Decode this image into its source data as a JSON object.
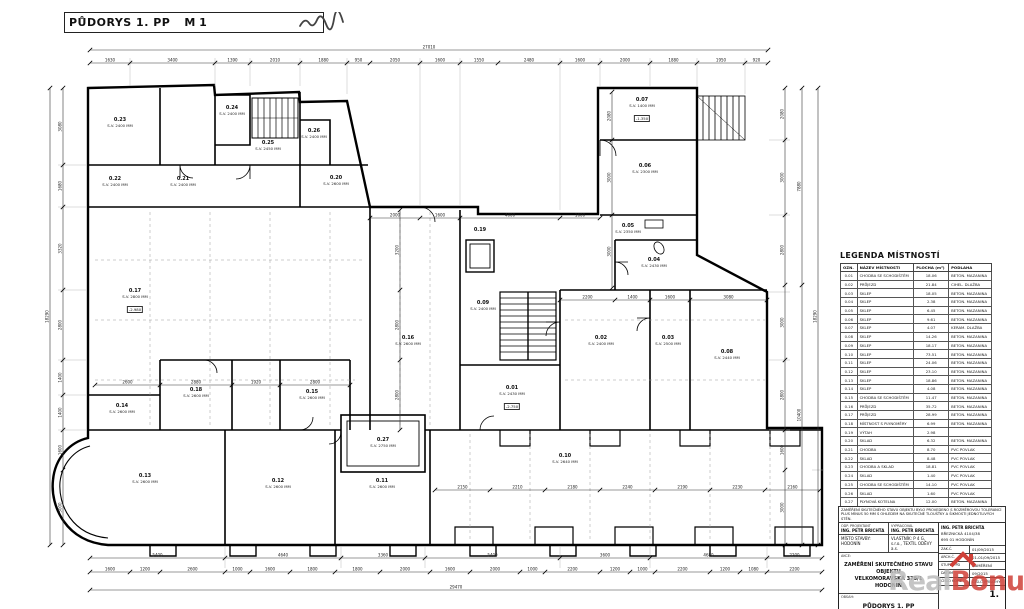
{
  "title": {
    "text": "PŮDORYS 1. PP",
    "scale": "M 1"
  },
  "plan": {
    "rooms": [
      {
        "id": "0.23",
        "sv": "S.V. 2400 MM",
        "x": 120,
        "y": 122
      },
      {
        "id": "0.24",
        "sv": "S.V. 2400 MM",
        "x": 232,
        "y": 110
      },
      {
        "id": "0.25",
        "sv": "S.V. 2450 MM",
        "x": 268,
        "y": 145
      },
      {
        "id": "0.26",
        "sv": "S.V. 2400 MM",
        "x": 314,
        "y": 133
      },
      {
        "id": "0.20",
        "sv": "S.V. 2600 MM",
        "x": 336,
        "y": 180
      },
      {
        "id": "0.22",
        "sv": "S.V. 2400 MM",
        "x": 115,
        "y": 181
      },
      {
        "id": "0.21",
        "sv": "S.V. 2400 MM",
        "x": 183,
        "y": 181
      },
      {
        "id": "0.17",
        "sv": "S.V. 2800 MM",
        "x": 135,
        "y": 293
      },
      {
        "id": "0.16",
        "sv": "S.V. 2600 MM",
        "x": 408,
        "y": 340
      },
      {
        "id": "0.09",
        "sv": "S.V. 2400 MM",
        "x": 483,
        "y": 305
      },
      {
        "id": "0.19",
        "sv": "",
        "x": 480,
        "y": 232
      },
      {
        "id": "0.01",
        "sv": "S.V. 2430 MM",
        "x": 512,
        "y": 390
      },
      {
        "id": "0.02",
        "sv": "S.V. 2400 MM",
        "x": 601,
        "y": 340
      },
      {
        "id": "0.03",
        "sv": "S.V. 2500 MM",
        "x": 668,
        "y": 340
      },
      {
        "id": "0.04",
        "sv": "S.V. 2430 MM",
        "x": 654,
        "y": 262
      },
      {
        "id": "0.05",
        "sv": "S.V. 2350 MM",
        "x": 628,
        "y": 228
      },
      {
        "id": "0.06",
        "sv": "S.V. 2300 MM",
        "x": 645,
        "y": 168
      },
      {
        "id": "0.07",
        "sv": "S.V. 1400 MM",
        "x": 642,
        "y": 102
      },
      {
        "id": "0.08",
        "sv": "S.V. 2440 MM",
        "x": 727,
        "y": 354
      },
      {
        "id": "0.10",
        "sv": "S.V. 2640 MM",
        "x": 565,
        "y": 458
      },
      {
        "id": "0.11",
        "sv": "S.V. 2600 MM",
        "x": 382,
        "y": 483
      },
      {
        "id": "0.12",
        "sv": "S.V. 2600 MM",
        "x": 278,
        "y": 483
      },
      {
        "id": "0.13",
        "sv": "S.V. 2600 MM",
        "x": 145,
        "y": 478
      },
      {
        "id": "0.14",
        "sv": "S.V. 2600 MM",
        "x": 122,
        "y": 408
      },
      {
        "id": "0.15",
        "sv": "S.V. 2600 MM",
        "x": 312,
        "y": 394
      },
      {
        "id": "0.18",
        "sv": "S.V. 2600 MM",
        "x": 196,
        "y": 392
      },
      {
        "id": "0.27",
        "sv": "S.V. 2750 MM",
        "x": 383,
        "y": 442
      }
    ],
    "elev_tags": [
      {
        "text": "-2.980",
        "x": 135,
        "y": 306
      },
      {
        "text": "-1.350",
        "x": 642,
        "y": 115
      },
      {
        "text": "-2.750",
        "x": 512,
        "y": 403
      }
    ]
  },
  "dims": {
    "chains": [
      {
        "o": "h",
        "p": 50,
        "cuts": [
          90,
          768
        ],
        "labels": [
          "27010"
        ]
      },
      {
        "o": "h",
        "p": 63,
        "cuts": [
          90,
          130,
          215,
          250,
          300,
          347,
          370,
          420,
          460,
          498,
          560,
          600,
          650,
          697,
          745,
          768
        ],
        "labels": [
          "1630",
          "3400",
          "1390",
          "2010",
          "1880",
          "950",
          "2050",
          "1600",
          "1550",
          "2480",
          "1600",
          "2000",
          "1880",
          "1950",
          "920"
        ]
      },
      {
        "o": "v",
        "p": 50,
        "cuts": [
          88,
          545
        ],
        "labels": [
          "18290"
        ]
      },
      {
        "o": "v",
        "p": 63,
        "cuts": [
          88,
          165,
          207,
          290,
          360,
          395,
          430,
          470,
          545
        ],
        "labels": [
          "3080",
          "1680",
          "3320",
          "2800",
          "1400",
          "1400",
          "1600",
          "3000"
        ]
      },
      {
        "o": "h",
        "p": 558,
        "cuts": [
          90,
          225,
          341,
          425,
          560,
          650,
          767,
          822
        ],
        "labels": [
          "5400",
          "4640",
          "3360",
          "5400",
          "3600",
          "4680",
          "2200"
        ]
      },
      {
        "o": "h",
        "p": 572,
        "cuts": [
          90,
          130,
          160,
          225,
          250,
          290,
          335,
          380,
          430,
          470,
          520,
          545,
          600,
          630,
          655,
          710,
          740,
          767,
          822
        ],
        "labels": [
          "1600",
          "1200",
          "2600",
          "1000",
          "1600",
          "1800",
          "1800",
          "2000",
          "1600",
          "2000",
          "1000",
          "2200",
          "1200",
          "1000",
          "2200",
          "1200",
          "1080",
          "2200"
        ]
      },
      {
        "o": "h",
        "p": 590,
        "cuts": [
          90,
          822
        ],
        "labels": [
          "29470"
        ]
      },
      {
        "o": "v",
        "p": 785,
        "cuts": [
          88,
          140,
          215,
          285,
          360,
          430,
          470,
          545
        ],
        "labels": [
          "2080",
          "3000",
          "2800",
          "3000",
          "2800",
          "1600",
          "3000"
        ]
      },
      {
        "o": "v",
        "p": 802,
        "cuts": [
          88,
          285,
          545
        ],
        "labels": [
          "7880",
          "10400"
        ]
      },
      {
        "o": "v",
        "p": 818,
        "cuts": [
          88,
          545
        ],
        "labels": [
          "18290"
        ]
      },
      {
        "o": "h",
        "p": 218,
        "cuts": [
          370,
          420,
          460,
          560,
          600
        ],
        "labels": [
          "2000",
          "1600",
          "4000",
          "1600"
        ]
      },
      {
        "o": "h",
        "p": 385,
        "cuts": [
          95,
          160,
          232,
          280,
          350
        ],
        "labels": [
          "2600",
          "2880",
          "1920",
          "2800"
        ]
      },
      {
        "o": "h",
        "p": 490,
        "cuts": [
          435,
          490,
          545,
          600,
          655,
          710,
          765,
          820
        ],
        "labels": [
          "2150",
          "2210",
          "2180",
          "2240",
          "2190",
          "2230",
          "2160"
        ]
      },
      {
        "o": "v",
        "p": 400,
        "cuts": [
          210,
          290,
          360,
          430
        ],
        "labels": [
          "3200",
          "2800",
          "2800"
        ]
      },
      {
        "o": "h",
        "p": 300,
        "cuts": [
          560,
          615,
          650,
          690,
          767
        ],
        "labels": [
          "2200",
          "1400",
          "1600",
          "3080"
        ]
      },
      {
        "o": "v",
        "p": 612,
        "cuts": [
          92,
          140,
          215,
          288
        ],
        "labels": [
          "2080",
          "3000",
          "3000"
        ]
      }
    ]
  },
  "legend": {
    "title": "LEGENDA MÍSTNOSTÍ",
    "columns": [
      "OZN.",
      "NÁZEV MÍSTNOSTI",
      "PLOCHA (m²)",
      "PODLAHA"
    ],
    "rows": [
      [
        "0.01",
        "CHODBA SE SCHODIŠTĚM",
        "18.06",
        "BETON. MAZANINA"
      ],
      [
        "0.02",
        "PRŮJEZD",
        "21.84",
        "CIHEL. DLAŽBA"
      ],
      [
        "0.03",
        "SKLEP",
        "18.05",
        "BETON. MAZANINA"
      ],
      [
        "0.04",
        "SKLEP",
        "2.38",
        "BETON. MAZANINA"
      ],
      [
        "0.05",
        "SKLEP",
        "6.45",
        "BETON. MAZANINA"
      ],
      [
        "0.06",
        "SKLEP",
        "9.61",
        "BETON. MAZANINA"
      ],
      [
        "0.07",
        "SKLEP",
        "4.07",
        "KERAM. DLAŽBA"
      ],
      [
        "0.08",
        "SKLEP",
        "14.26",
        "BETON. MAZANINA"
      ],
      [
        "0.09",
        "SKLEP",
        "18.17",
        "BETON. MAZANINA"
      ],
      [
        "0.10",
        "SKLEP",
        "73.51",
        "BETON. MAZANINA"
      ],
      [
        "0.11",
        "SKLEP",
        "24.06",
        "BETON. MAZANINA"
      ],
      [
        "0.12",
        "SKLEP",
        "23.10",
        "BETON. MAZANINA"
      ],
      [
        "0.13",
        "SKLEP",
        "18.86",
        "BETON. MAZANINA"
      ],
      [
        "0.14",
        "SKLEP",
        "4.08",
        "BETON. MAZANINA"
      ],
      [
        "0.15",
        "CHODBA SE SCHODIŠTĚM",
        "11.47",
        "BETON. MAZANINA"
      ],
      [
        "0.16",
        "PRŮJEZD",
        "35.72",
        "BETON. MAZANINA"
      ],
      [
        "0.17",
        "PRŮJEZD",
        "28.99",
        "BETON. MAZANINA"
      ],
      [
        "0.18",
        "MÍSTNOST S PLYNOMĚRY",
        "6.99",
        "BETON. MAZANINA"
      ],
      [
        "0.19",
        "VÝTAH",
        "2.98",
        ""
      ],
      [
        "0.20",
        "SKLAD",
        "6.32",
        "BETON. MAZANINA"
      ],
      [
        "0.21",
        "CHODBA",
        "8.70",
        "PVC POVLAK"
      ],
      [
        "0.22",
        "SKLAD",
        "8.48",
        "PVC POVLAK"
      ],
      [
        "0.23",
        "CHODBA A SKLAD",
        "18.81",
        "PVC POVLAK"
      ],
      [
        "0.24",
        "SKLAD",
        "1.40",
        "PVC POVLAK"
      ],
      [
        "0.25",
        "CHODBA SE SCHODIŠTĚM",
        "14.10",
        "PVC POVLAK"
      ],
      [
        "0.26",
        "SKLAD",
        "1.60",
        "PVC POVLAK"
      ],
      [
        "0.27",
        "PLYNOVÁ KOTELNA",
        "12.00",
        "BETON. MAZANINA"
      ]
    ]
  },
  "titleblock": {
    "note1": "ZAMĚŘENÍ SKUTEČNÉHO STAVU OBJEKTU BYLO PROVEDENO S ROZMĚROVOU TOLERANCÍ",
    "note2": "PLUS MÍNUS 50 MM S OHLEDEM NA SKUTEČNÉ TLOUŠŤKY A ŠIKMOSTI JEDNOTLIVÝCH STĚN.",
    "odp_label": "ODP. PROJEKTANT",
    "odp": "ING. PETR BRICHTA",
    "vyp_label": "VYPRACOVAL",
    "vyp": "ING. PETR BRICHTA",
    "firm_name": "ING. PETR BRICHTA",
    "firm_street": "BŘEZNICKÁ 4104/38",
    "firm_city": "695 01 HODONÍN",
    "misto": "MÍSTO STAVBY: HODONÍN",
    "vlastnik": "VLASTNÍK: P 4 G, s.r.o., TEXTIL ODĚVY a.s.",
    "akce_label": "AKCE:",
    "akce1": "ZAMĚŘENÍ SKUTEČNÉHO STAVU OBJEKTU",
    "akce2": "VELKOMORAVSKÁ 378/1 HODONÍN",
    "obsah_label": "OBSAH:",
    "obsah": "PŮDORYS 1. PP",
    "meta_rows": [
      [
        "ZAK.Č.",
        "01/09/2015"
      ],
      [
        "ARCH.Č.",
        "01-01/09/2015"
      ],
      [
        "STUPEŇ PD",
        "ZAMĚŘENÍ"
      ],
      [
        "DATUM",
        "09/2015"
      ]
    ],
    "kopie_label": "ČÍSLO KOPIE",
    "priloha_label": "ČÍSLO PŘÍLOHY:",
    "priloha": "1."
  },
  "watermark": {
    "part1": "Real",
    "part2": "Bonus",
    "part3": ".cz"
  },
  "colors": {
    "wall": "#000000",
    "dim": "#333333",
    "grid": "#999999",
    "wm_gray": "#bcbcbc",
    "wm_red": "#d04038"
  }
}
